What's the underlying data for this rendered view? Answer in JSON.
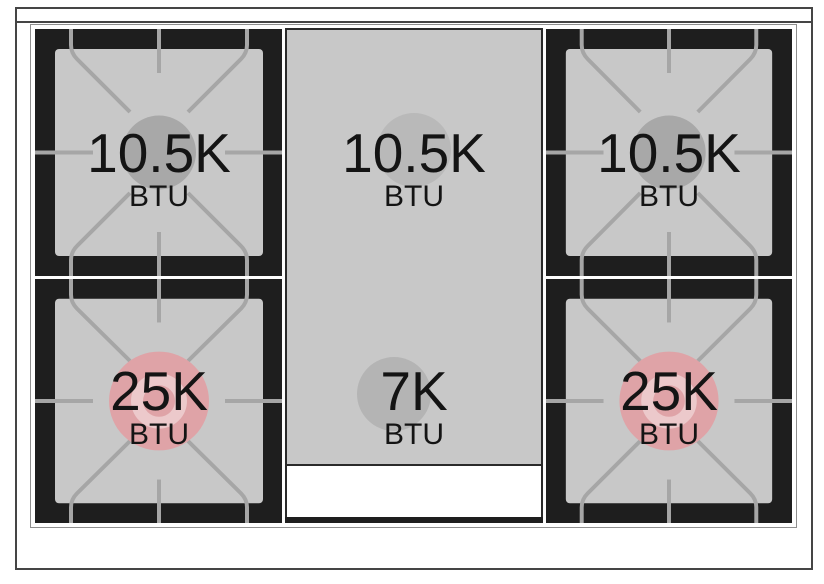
{
  "diagram": {
    "name": "gas-range-cooktop-burner-layout",
    "burners": [
      {
        "id": "top-left",
        "power": "10.5K",
        "unit": "BTU"
      },
      {
        "id": "top-center",
        "power": "10.5K",
        "unit": "BTU"
      },
      {
        "id": "top-right",
        "power": "10.5K",
        "unit": "BTU"
      },
      {
        "id": "bottom-left",
        "power": "25K",
        "unit": "BTU"
      },
      {
        "id": "bottom-center",
        "power": "7K",
        "unit": "BTU"
      },
      {
        "id": "bottom-right",
        "power": "25K",
        "unit": "BTU"
      }
    ],
    "colors": {
      "cooktop_black": "#1e1e1e",
      "surface_gray": "#c8c8c8",
      "grate_line_gray": "#a6a6a6",
      "standard_burner_circle": "#a8a8a8",
      "high_power_burner_pink": "#dfa3a7",
      "high_power_inner_ring": "#ecc9cb",
      "griddle_circle_gray": "#b9b9b9",
      "frame_border": "#454545"
    }
  }
}
